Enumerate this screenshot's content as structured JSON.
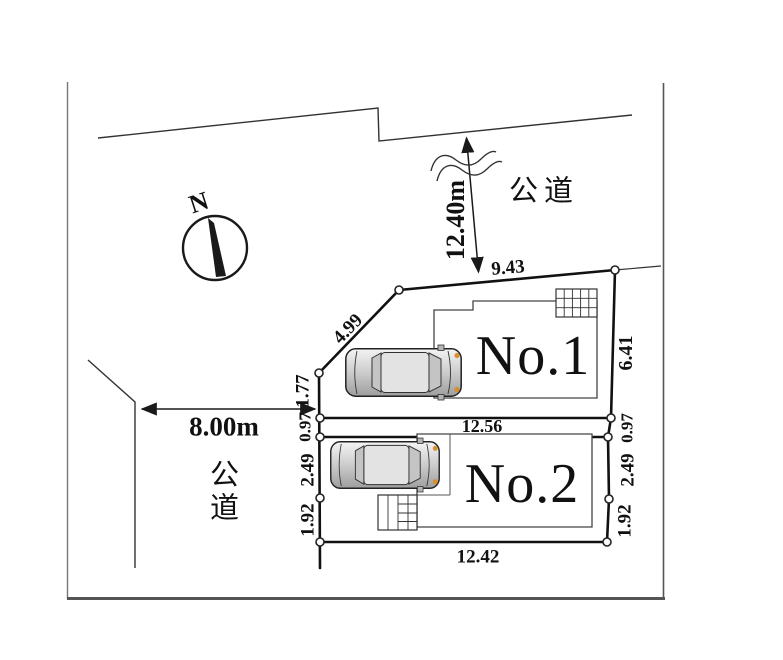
{
  "diagram": {
    "type": "real-estate site plan",
    "compass_label": "N",
    "roads": {
      "top": {
        "name": "公道",
        "width": "12.40m"
      },
      "left": {
        "name": "公道",
        "width": "8.00m"
      }
    },
    "lots": {
      "lot1": {
        "name": "No.1",
        "top": "9.43",
        "left_diagonal": "4.99",
        "left": "1.77",
        "right": "6.41"
      },
      "lot2": {
        "name": "No.2",
        "top": "12.56",
        "bottom": "12.42",
        "left_upper": "0.97",
        "left_middle": "2.49",
        "left_lower": "1.92",
        "right_upper": "0.97",
        "right_middle": "2.49",
        "right_lower": "1.92"
      }
    },
    "icons": {
      "compass": "north-compass-icon",
      "cars": "car-top-view-icon",
      "break": "wavy-break-icon"
    },
    "colors": {
      "line": "#1a1a1a",
      "frame": "#666666",
      "building_line": "#444444",
      "car_body": "#c9c9c9",
      "car_light": "#d98e2f",
      "background": "#ffffff"
    }
  }
}
